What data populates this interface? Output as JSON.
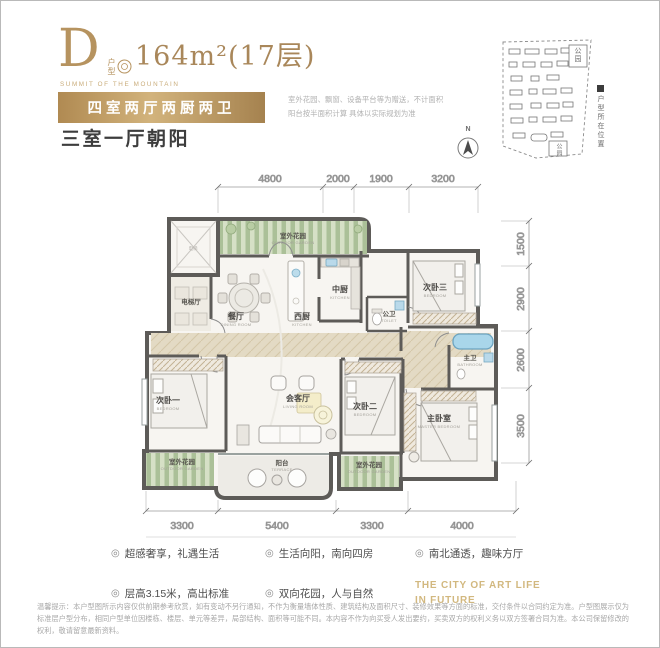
{
  "header": {
    "plan_letter": "D",
    "plan_type_label": "户型",
    "area": "164m²",
    "floor": "(17层)",
    "series_en": "SUMMIT OF THE MOUNTAIN",
    "badge": "四室两厅两厨两卫",
    "subtitle": "三室一厅朝阳",
    "note_line1": "室外花园、飘窗、设备平台等为赠送，不计面积",
    "note_line2": "阳台按半面积计算 具体以实际规划为准"
  },
  "site_map": {
    "park_top": "公园",
    "park_bottom": "公园",
    "legend": "户型所在位置",
    "compass": "N"
  },
  "floor_plan": {
    "rooms": {
      "elevator": {
        "zh": "电梯"
      },
      "elevator_hall": {
        "zh": "电梯厅"
      },
      "garden_top": {
        "zh": "室外花园",
        "en": "OUTDOOR GARDEN"
      },
      "dining": {
        "zh": "餐厅",
        "en": "DINING ROOM"
      },
      "west_kitchen": {
        "zh": "西厨",
        "en": "KITCHEN"
      },
      "chinese_kitchen": {
        "zh": "中厨",
        "en": "KITCHEN"
      },
      "public_bath": {
        "zh": "公卫",
        "en": "TOILET"
      },
      "bedroom3": {
        "zh": "次卧三",
        "en": "BEDROOM"
      },
      "master_bath": {
        "zh": "主卫",
        "en": "BATHROOM"
      },
      "bedroom1": {
        "zh": "次卧一",
        "en": "BEDROOM"
      },
      "living": {
        "zh": "会客厅",
        "en": "LIVING ROOM"
      },
      "bedroom2": {
        "zh": "次卧二",
        "en": "BEDROOM"
      },
      "master_bedroom": {
        "zh": "主卧室",
        "en": "MASTER BEDROOM"
      },
      "garden_bl": {
        "zh": "室外花园",
        "en": "OUTDOOR GARDEN"
      },
      "balcony": {
        "zh": "阳台",
        "en": "TERRACE"
      },
      "garden_br": {
        "zh": "室外花园",
        "en": "OUTDOOR GARDEN"
      }
    },
    "dims": {
      "top": [
        "4800",
        "2000",
        "1900",
        "3200"
      ],
      "right": [
        "1500",
        "2900",
        "2600",
        "3500"
      ],
      "bottom": [
        "3300",
        "5400",
        "3300",
        "4000"
      ]
    }
  },
  "features": {
    "bullet": "◎",
    "items": [
      "超感奢享，礼遇生活",
      "生活向阳，南向四房",
      "南北通透，趣味方厅",
      "层高3.15米，高出标准",
      "双向花园，人与自然"
    ],
    "slogan_line1": "THE CITY OF ART LIFE",
    "slogan_line2": "IN FUTURE"
  },
  "disclaimer": "温馨提示：本户型图所示内容仅供前期参考欣赏，如有变动不另行通知，不作为衡量墙体性质、建筑结构及面积尺寸、装修效果等方面的标准，交付条件以合同约定为准。户型图展示仅为标准层户型分布，相同户型单位因楼栋、楼层、单元等差异，局部结构、面积等可能不同。本内容不作为向买受人发出要约，买卖双方的权利义务以双方签署合同为准。本公司保留修改的权利，敬请留意最新资料。"
}
